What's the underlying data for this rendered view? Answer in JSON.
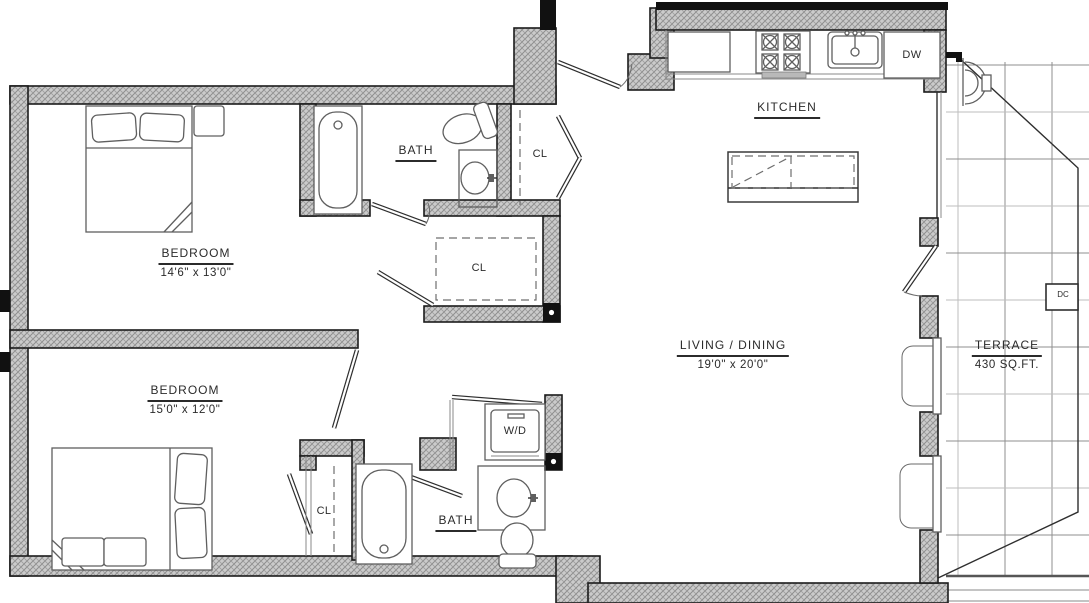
{
  "rooms": {
    "bedroom1": {
      "name": "BEDROOM",
      "dims": "14'6\" x 13'0\""
    },
    "bedroom2": {
      "name": "BEDROOM",
      "dims": "15'0\" x 12'0\""
    },
    "living_dining": {
      "name": "LIVING / DINING",
      "dims": "19'0\" x 20'0\""
    },
    "kitchen": {
      "name": "KITCHEN"
    },
    "terrace": {
      "name": "TERRACE",
      "area": "430 SQ.FT."
    },
    "bath_upper": {
      "name": "BATH"
    },
    "bath_lower": {
      "name": "BATH"
    },
    "closet_upper": {
      "name": "CL"
    },
    "closet_middle": {
      "name": "CL"
    },
    "closet_lower": {
      "name": "CL"
    }
  },
  "appliances": {
    "dishwasher": "DW",
    "washer_dryer": "W/D",
    "dc_unit": "DC"
  },
  "colors": {
    "wall_fill": "#cbcbcb",
    "wall_hatch": "#8e8e8e",
    "line": "#2e2e2e",
    "fixture": "#5f5f5f"
  }
}
